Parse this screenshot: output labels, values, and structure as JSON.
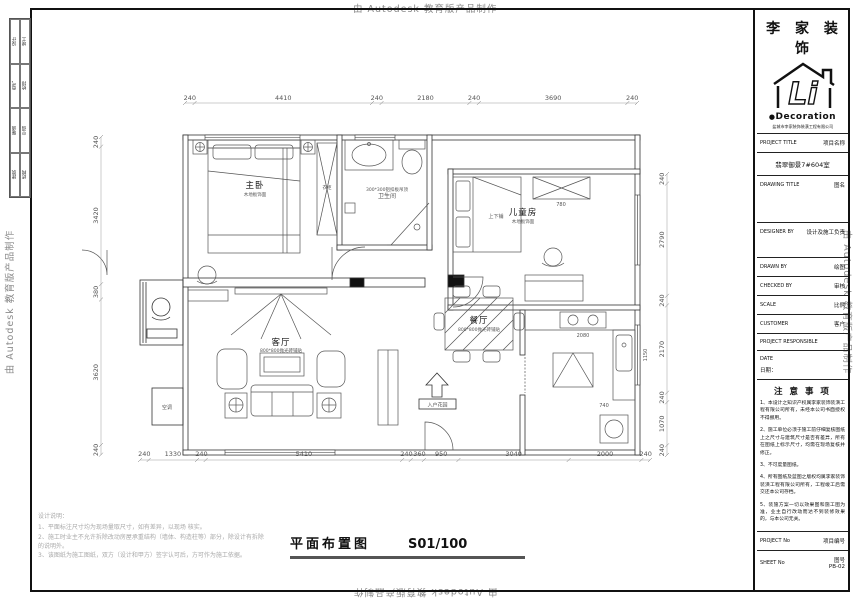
{
  "watermark": {
    "text": "由 Autodesk 教育版产品制作"
  },
  "strip": {
    "cells": [
      "设计",
      "竣工",
      "电气",
      "给排",
      "暖通",
      "空调",
      "建筑",
      "结构"
    ]
  },
  "title_block": {
    "brand": "李 家 装 饰",
    "logo_li": "Li",
    "logo_deco_dot": "●",
    "logo_deco": "Decoration",
    "company_full": "盐城市李家装饰装潢工程有限公司",
    "project_title_en": "PROJECT TITLE",
    "project_title_cn": "项目名称",
    "project_name": "翡翠御景7#604室",
    "drawing_title_en": "DRAWING TITLE",
    "drawing_title_cn": "图名",
    "designer_en": "DESIGNER BY",
    "designer_cn": "设计及施工负责",
    "drawn_en": "DRAWN BY",
    "drawn_cn": "绘图",
    "checked_en": "CHECKED BY",
    "checked_cn": "审核",
    "scale_en": "SCALE",
    "scale_cn": "比例",
    "customer_en": "CUSTOMER",
    "customer_cn": "客户",
    "responsible_en": "PROJECT RESPONSIBLE",
    "date_en": "DATE",
    "date_cn": "日期：",
    "notes_title": "注 意 事 项",
    "notes": [
      "1、本设计之知识产权属李家装饰装潢工程有限公司所有，未经本公司书面授权不得挪用。",
      "2、施工单位必须于施工前仔细复核图纸上之尺寸与建筑尺寸是否有差异，所有在图纸上标示尺寸，均需在现场复核并修正。",
      "3、不可度量图纸。",
      "4、所有图纸及蓝图之版权均属李家装饰装潢工程有限公司所有，工程竣工后需交还本公司存档。",
      "5、装施方案一切以效果图和施工图为准，业主自行改动而达不到装修效果的，与本公司无关。"
    ],
    "project_no_en": "PROJECT No",
    "project_no_cn": "项目编号",
    "sheet_no_en": "SHEET No",
    "sheet_no_cn": "图号",
    "sheet_no_value": "PB-02"
  },
  "drawing_title": {
    "name": "平面布置图",
    "scale": "S01/100"
  },
  "design_notes": {
    "title": "设计说明：",
    "lines": [
      "1、平面标注尺寸均为现场量取尺寸，如有差异，以现场 核实。",
      "2、施工时业主不允许拆除改动房屋承重结构（墙体、构造柱等）部分，除设计有拆除的说明外。",
      "3、该图纸为施工图纸，双方（设计和甲方）签字认可后，方可作为施工依据。"
    ]
  },
  "plan": {
    "dims_top": [
      "240",
      "4410",
      "240",
      "2180",
      "240",
      "3690",
      "240"
    ],
    "dims_bottom": [
      "240",
      "1330",
      "240",
      "5410",
      "240",
      "360",
      "950",
      "3040",
      "2000",
      "240"
    ],
    "dims_left": [
      "240",
      "3420",
      "380",
      "3620",
      "240"
    ],
    "dims_right": [
      "240",
      "2790",
      "240",
      "2170",
      "240",
      "1070",
      "240"
    ],
    "rooms": {
      "master": {
        "name": "主卧",
        "note": "木地板饰面",
        "closet": "衣柜"
      },
      "bath": {
        "name": "卫生间",
        "note": "300*300铝扣板吊顶"
      },
      "kids": {
        "name": "儿童房",
        "note": "木地板饰面",
        "bed": "上下铺",
        "closet_dim": "780"
      },
      "living": {
        "name": "客厅",
        "note": "800*800抛光砖铺贴"
      },
      "dining": {
        "name": "餐厅",
        "note": "800*800抛光砖铺贴"
      },
      "ac": "空调",
      "entrance": "入户花园"
    },
    "inline_dims": {
      "stove": "2080",
      "kitchen_side": "1150",
      "kitchen_low": "740"
    }
  }
}
